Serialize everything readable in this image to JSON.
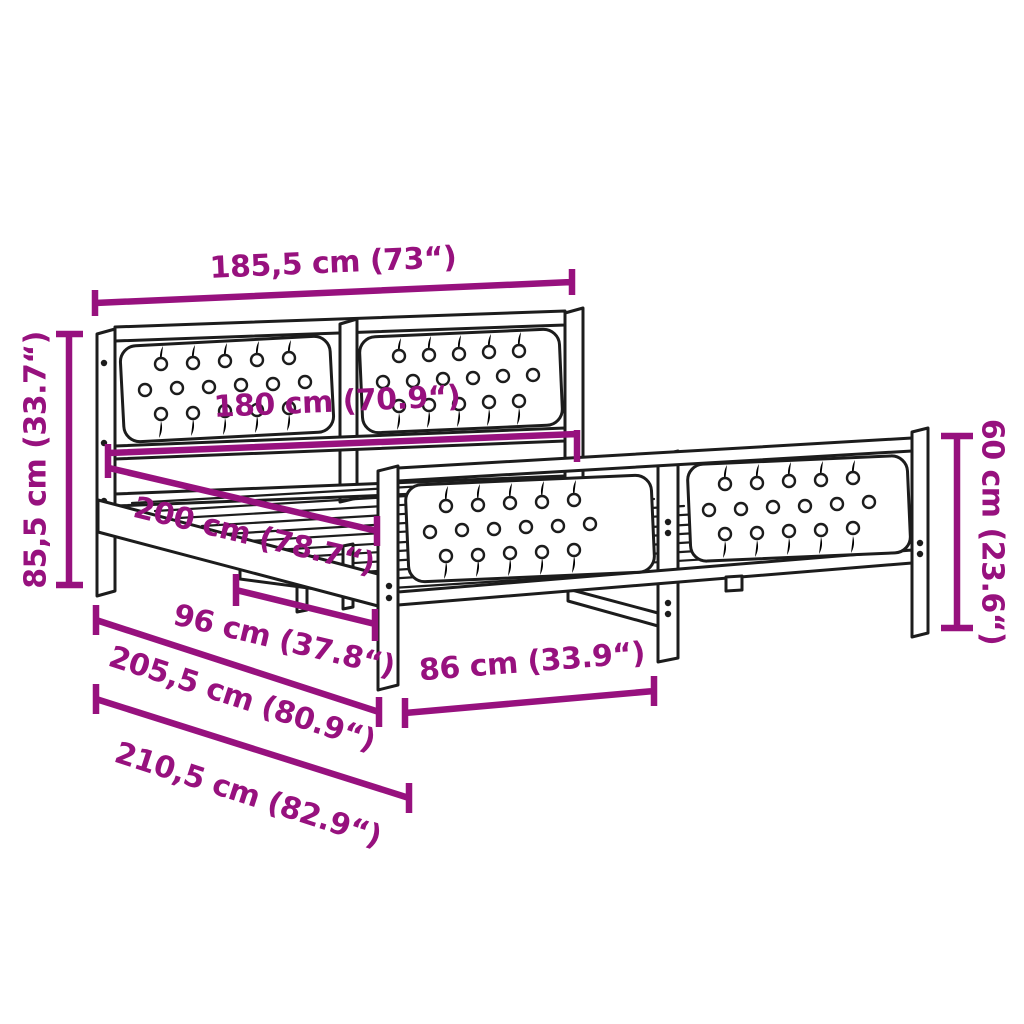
{
  "diagram": {
    "kind": "product-dimension-diagram",
    "illustration": "bed-frame-line-drawing"
  },
  "colors": {
    "dimension_annotation": "#97117E",
    "drawing_line": "#1c1c1c",
    "background": "#ffffff"
  },
  "dimensions": {
    "overall_width": "185,5 cm (73“)",
    "inner_width": "180 cm (70.9“)",
    "headboard_height": "85,5 cm (33.7“)",
    "inner_length": "200 cm (78.7“)",
    "support_spacing": "96 cm (37.8“)",
    "frame_length": "205,5 cm (80.9“)",
    "overall_length": "210,5 cm (82.9“)",
    "footboard_section_length": "86 cm (33.9“)",
    "footboard_height": "60 cm (23.6“)"
  }
}
